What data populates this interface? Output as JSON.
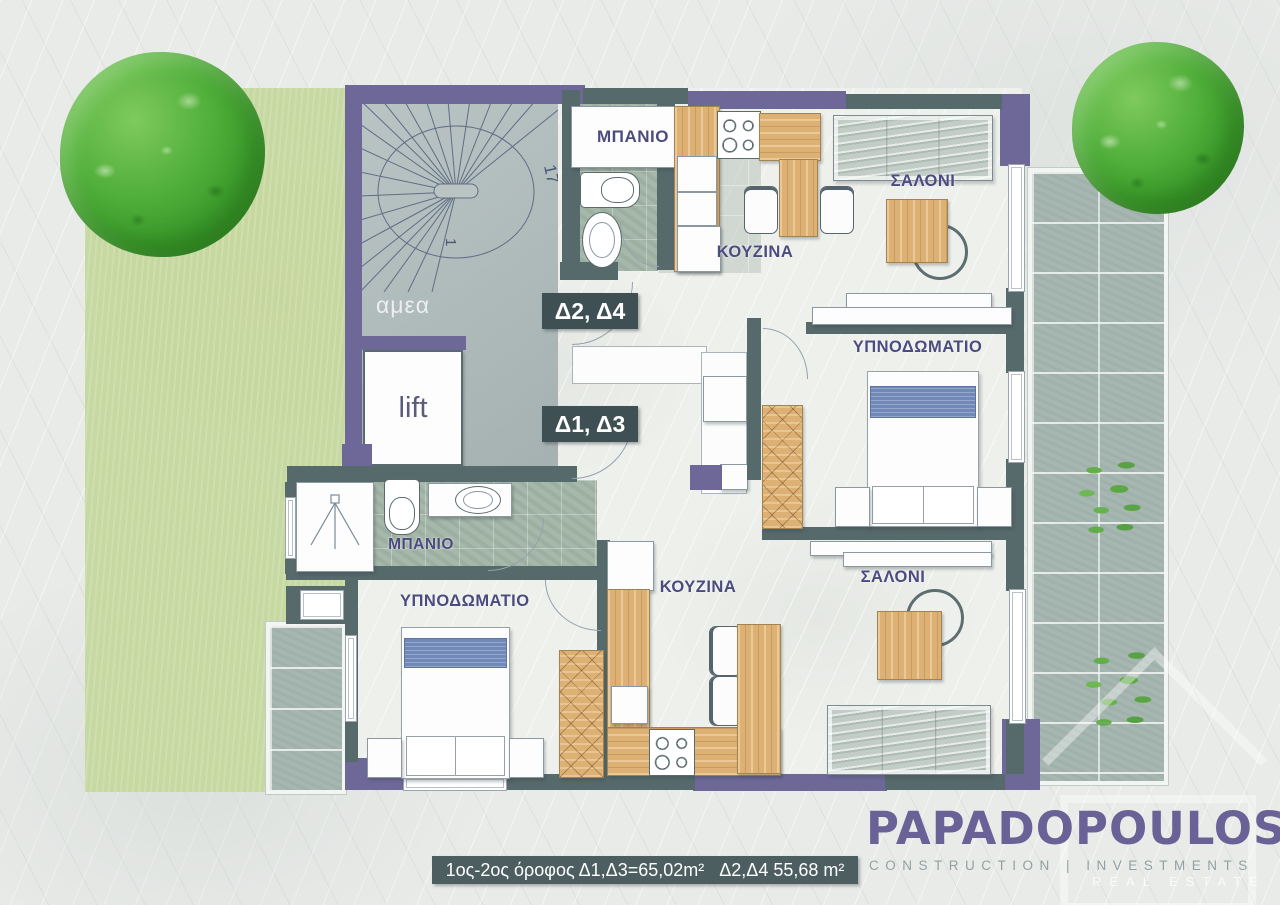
{
  "branding": {
    "company": "PAPADOPOULOS",
    "tagline": "CONSTRUCTION | INVESTMENTS",
    "watermark": "REAL ESTATE"
  },
  "caption": {
    "text": "1ος-2ος όροφος Δ1,Δ3=65,02m²   Δ2,Δ4 55,68 m²"
  },
  "apartments": {
    "upper": "Δ2, Δ4",
    "lower": "Δ1, Δ3"
  },
  "rooms": {
    "bathroom_top": "ΜΠΑΝΙΟ",
    "kitchen_top": "ΚΟΥΖΙΝΑ",
    "living_top": "ΣΑΛΟΝΙ",
    "bedroom_right": "ΥΠΝΟΔΩΜΑΤΙΟ",
    "bathroom_left": "ΜΠΑΝΙΟ",
    "bedroom_bottom": "ΥΠΝΟΔΩΜΑΤΙΟ",
    "kitchen_bottom": "ΚΟΥΖΙΝΑ",
    "living_bottom": "ΣΑΛΟΝΙ"
  },
  "stairwell": {
    "accessible_label": "αμεα",
    "lift_label": "lift",
    "top_step": "17",
    "bottom_step": "1"
  },
  "colors": {
    "wall_purple": "#6E6899",
    "wall_slate": "#56696B",
    "wood": "#DDB074",
    "garden_green": "#C7D9A2",
    "bed_blue": "#7089B8",
    "tile_green": "#A6B8AA",
    "label_ink": "#4C4B80",
    "tag_bg": "#3E5053",
    "caption_bg": "#4D5E60",
    "logo_purple": "#6A6296",
    "tagline_gray": "#93A0A2"
  }
}
